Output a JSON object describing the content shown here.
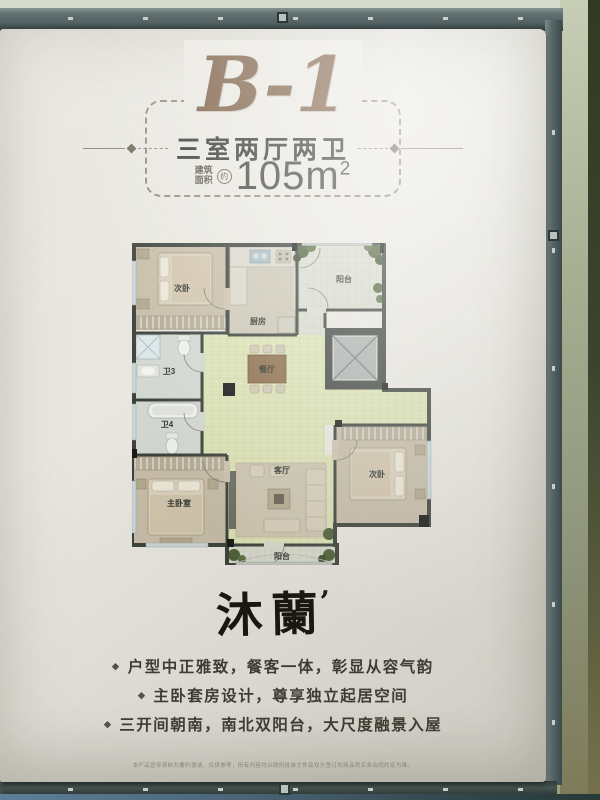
{
  "header": {
    "unit": "B-1",
    "layout": "三室两厅两卫",
    "area_label_top": "建筑",
    "area_label_bottom": "面积",
    "area_approx": "约",
    "area_value": "105m",
    "area_exponent": "2"
  },
  "plan": {
    "rooms": {
      "bedroom_top_left": "次卧",
      "kitchen": "厨房",
      "balcony_top": "阳台",
      "bath_3": "卫3",
      "bath_4": "卫4",
      "dining": "餐厅",
      "master_bedroom": "主卧室",
      "living": "客厅",
      "bedroom_bottom_right": "次卧",
      "balcony_bottom": "阳台"
    }
  },
  "brand": {
    "name": "沐蘭",
    "mark": "’"
  },
  "features": {
    "bullet": "◆",
    "items": [
      "户型中正雅致，餐客一体，彰显从容气韵",
      "主卧套房设计，尊享独立起居空间",
      "三开间朝南，南北双阳台，大尺度融景入屋"
    ]
  },
  "disclaimer": "本产品宣传资料为要约邀请，仅供参考，所有内容均以政府批准文件及双方签订的商品房买卖合同约定为准。",
  "colors": {
    "accent_brown": "#7b5d43",
    "wall_dark": "#3d433c",
    "tile_green": "#dde3b6",
    "frame_slate": "#5f6e70"
  }
}
